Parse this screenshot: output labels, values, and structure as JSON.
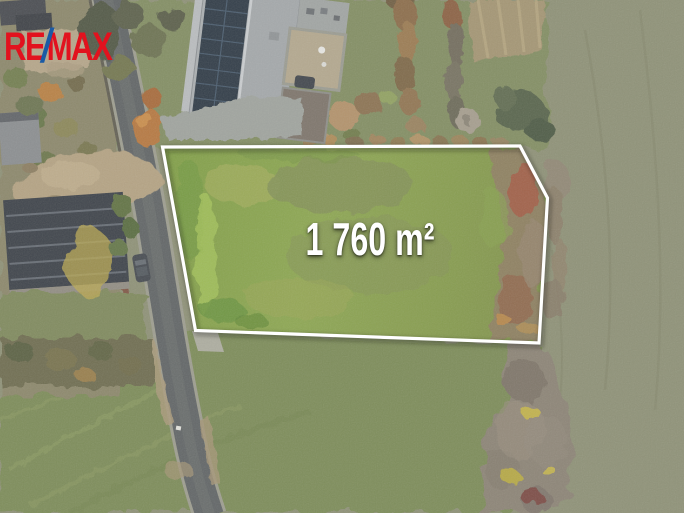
{
  "brand": {
    "name": "RE/MAX",
    "re": "RE",
    "slash": "/",
    "max": "MAX",
    "red": "#E2121E",
    "blue": "#1B5AA5"
  },
  "listing": {
    "area_label": "1 760 m²"
  },
  "scene": {
    "type": "aerial-drone-photo-of-building-plot",
    "plot_outline_color": "#FFFFFF",
    "plot_grass_color": "#85A04A",
    "road_color": "#5E6263",
    "field_color": "#8C8F74"
  }
}
